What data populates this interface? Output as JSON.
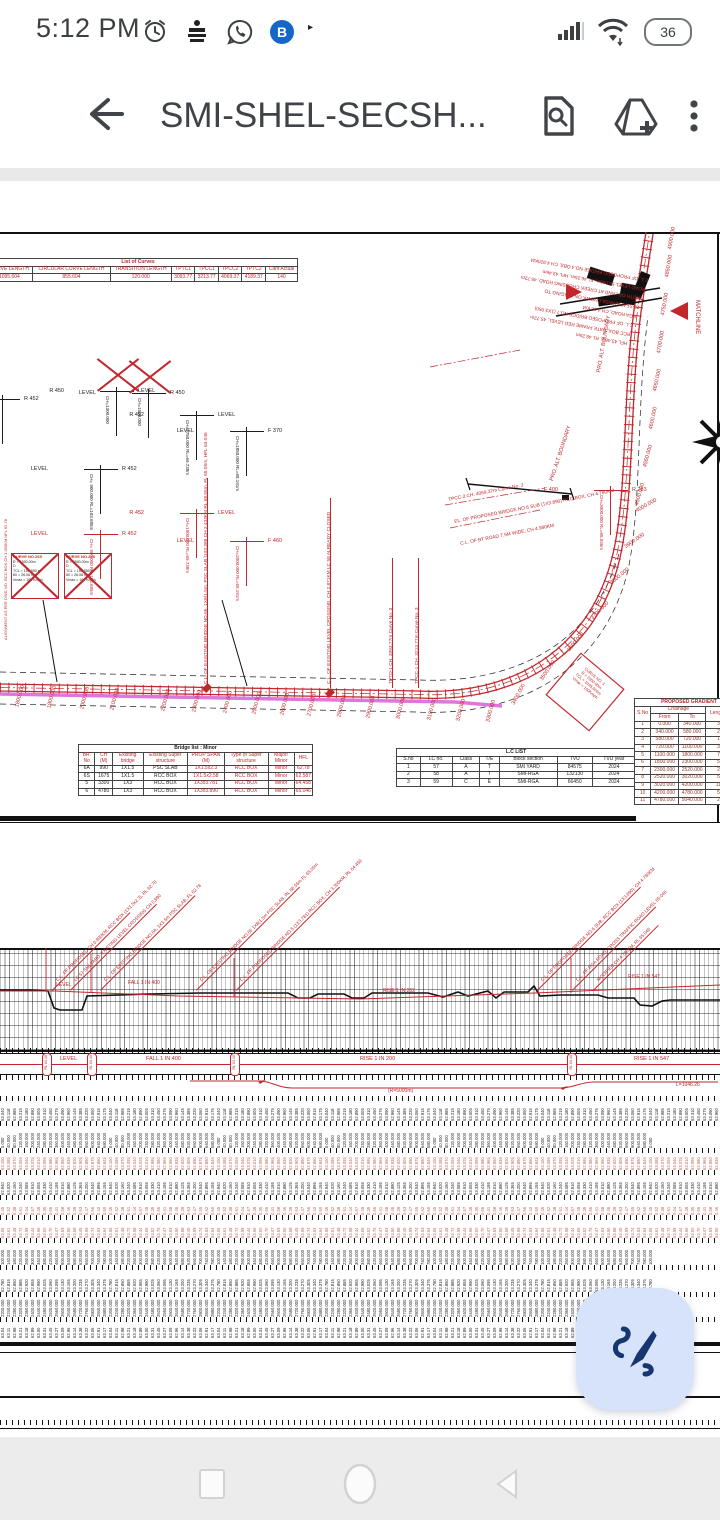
{
  "status_bar": {
    "time": "5:12 PM",
    "battery_percent": "36",
    "notification_icons": [
      "alarm-icon",
      "news-app-icon",
      "whatsapp-icon",
      "bob-app-icon"
    ],
    "more_indicator": "▸"
  },
  "app_bar": {
    "title": "SMI-SHEL-SECSH...",
    "actions": [
      "find-in-page",
      "add-to-drive",
      "more-options"
    ]
  },
  "plan": {
    "curves_table": {
      "title": "List of Curves",
      "headers": [
        "N",
        "CURVE LENGTH",
        "CIRCULAR CURVE LENGTH",
        "TRANSITION LENGTH",
        "TPTC1",
        "TPCC1",
        "TPCC2",
        "TPTC2",
        "Cant Actual"
      ],
      "row": [
        "",
        "1095.604",
        "855.604",
        "120.000",
        "3093.77",
        "3213.77",
        "4069.37",
        "4189.37",
        "140"
      ]
    },
    "crossed_curve_boxes": [
      {
        "title": "CURVE NO.265",
        "lines": [
          "R    = 1500.00m",
          "D",
          "TCL  = 150.550 m",
          "60   = 26.06 mm",
          "Vmax = 160 Kmph"
        ]
      },
      {
        "title": "CURVE NO.248",
        "lines": [
          "R    = 2500.00m",
          "D",
          "TCL  = 150.550 m",
          "60   = 26.06 mm",
          "Vmax = 160 Kmph"
        ]
      }
    ],
    "level_crossings": [
      {
        "x": -14,
        "y": 396,
        "color": "#1d1d1f",
        "left": "LEVEL",
        "right": "R 452",
        "note": "CH= 800.000",
        "crossed": false
      },
      {
        "x": 84,
        "y": 466,
        "color": "#1d1d1f",
        "left": "LEVEL",
        "right": "R 452",
        "note": "CH= 900.000  RL=103.685m",
        "crossed": false
      },
      {
        "x": 100,
        "y": 388,
        "color": "#1d1d1f",
        "left": "R 450",
        "right": "LEVEL",
        "note": "CH=1300.000",
        "crossed": true
      },
      {
        "x": 132,
        "y": 390,
        "color": "#1d1d1f",
        "left": "LEVEL",
        "right": "R 450",
        "note": "CH=1500.000",
        "crossed": true
      },
      {
        "x": 180,
        "y": 412,
        "color": "#1d1d1f",
        "left": "R 452",
        "right": "LEVEL",
        "note": "CH=1750.000  RL=69.738m",
        "crossed": false
      },
      {
        "x": 230,
        "y": 428,
        "color": "#1d1d1f",
        "left": "LEVEL",
        "right": "F 370",
        "note": "CH=1850.000  RL=68.191m",
        "crossed": false
      },
      {
        "x": 84,
        "y": 531,
        "color": "#c2272d",
        "left": "LEVEL",
        "right": "R 452",
        "note": "CH= 900.000  RL=103.685m",
        "crossed": false
      },
      {
        "x": 180,
        "y": 510,
        "color": "#c2272d",
        "left": "R 452",
        "right": "LEVEL",
        "note": "CH=1900.000  RL=69.738m",
        "crossed": false
      },
      {
        "x": 230,
        "y": 538,
        "color": "#c2272d",
        "left": "LEVEL",
        "right": "F 460",
        "note": "CH=2000.000  RL=68.191m",
        "crossed": false
      },
      {
        "x": 594,
        "y": 487,
        "color": "#c2272d",
        "left": "F 400",
        "right": "R 283",
        "note": "CH=3000.000  RL=65.046m",
        "crossed": false
      }
    ],
    "track_leaders": [
      {
        "x": 207,
        "h": 210,
        "text": "C.L. OF EXISTING BRIDGE NO.66, 1X8(1.5m, PSC SLAB,)103.388 CH 2.433KM  RL 68.55m, FL 65.05m, HFL 63.046"
      },
      {
        "x": 330,
        "h": 190,
        "text": "C.L. OF EXISTING LEVEL CROSSING, CH 2.871KM  LC 58 ALREADY CLOSED"
      },
      {
        "x": 392,
        "h": 130,
        "text": "TPTO-1 CH. 3093.77m Curve No. 3"
      },
      {
        "x": 418,
        "h": 130,
        "text": "TPCC-1 CH. 3213.77m Curve No. 3"
      }
    ],
    "curve_leaders": [
      {
        "text": "TPCC-2 CH. 4069.37m Curve No. 3"
      },
      {
        "text": "EL. OF PROPOSED BRIDGE NO.6 SUB (1X3.890) RCC BOX, CH 4.780KM"
      },
      {
        "text": "C.L. OF BT ROAD 7.5M WIDE, CH 4.980KM"
      }
    ],
    "boundary_label": "PRO. ALT. BOUNDARY",
    "matchline_label": "MATCHLINE",
    "left_edge_note": "ALIGNMENT AS PER DWG NO. RCC BOX CH 1.050KM  HFL 62.78",
    "top_right_notes": [
      "C.L. OF PROPOSED BRIDGE NO.4 OBS, CH 4.920KM",
      "ROAD LEVEL 66.046m, FL 46.25m, HFL 43.46m",
      "WIDTH OF LAND AT CREEK CROSSING ROAD, 45.72m",
      "25 SEAT AHINSA CHOWK ON STAGING TO",
      "RGA ROAD, CH 4.98 KM",
      "C.L. OF PROPOSED BRIDGE NO.7 (1X3.050)",
      "RCC BOX, DATE FRAME RED LEVEL, 45.72m",
      "HFL 43.46m, RL 48.25m"
    ],
    "diamond_note_lines": [
      "CURVE NO. 3",
      "R = 2500.00m",
      "TCL = 1095.604m",
      "Vmax = 160Kmph"
    ],
    "chainage_labels": [
      {
        "t": "1800.000",
        "x": 20,
        "y": 702,
        "r": 75
      },
      {
        "t": "1900.000",
        "x": 52,
        "y": 703,
        "r": 75
      },
      {
        "t": "2000.000",
        "x": 85,
        "y": 704,
        "r": 75
      },
      {
        "t": "2100.000",
        "x": 115,
        "y": 705,
        "r": 75
      },
      {
        "t": "2200.000",
        "x": 166,
        "y": 706,
        "r": 75
      },
      {
        "t": "2300.000",
        "x": 197,
        "y": 707,
        "r": 75
      },
      {
        "t": "2400.000",
        "x": 228,
        "y": 708,
        "r": 75
      },
      {
        "t": "2500.000",
        "x": 257,
        "y": 709,
        "r": 75
      },
      {
        "t": "2600.000",
        "x": 285,
        "y": 710,
        "r": 75
      },
      {
        "t": "2700.000",
        "x": 312,
        "y": 711,
        "r": 75
      },
      {
        "t": "2800.000",
        "x": 342,
        "y": 712,
        "r": 75
      },
      {
        "t": "2900.000",
        "x": 371,
        "y": 713,
        "r": 75
      },
      {
        "t": "3000.000",
        "x": 401,
        "y": 714,
        "r": 75
      },
      {
        "t": "3100.000",
        "x": 432,
        "y": 715,
        "r": 75
      },
      {
        "t": "3200.000",
        "x": 461,
        "y": 716,
        "r": 75
      },
      {
        "t": "3300.000",
        "x": 491,
        "y": 717,
        "r": 75
      },
      {
        "t": "3400.000",
        "x": 516,
        "y": 700,
        "r": 62
      },
      {
        "t": "3500.000",
        "x": 544,
        "y": 676,
        "r": 56
      },
      {
        "t": "3600.000",
        "x": 571,
        "y": 647,
        "r": 50
      },
      {
        "t": "3700.000",
        "x": 594,
        "y": 615,
        "r": 45
      },
      {
        "t": "3800.000",
        "x": 613,
        "y": 580,
        "r": 40
      },
      {
        "t": "3900.000",
        "x": 627,
        "y": 544,
        "r": 35
      },
      {
        "t": "4000.000",
        "x": 638,
        "y": 508,
        "r": 30
      },
      {
        "t": "4500.000",
        "x": 640,
        "y": 500,
        "r": 75
      },
      {
        "t": "4550.000",
        "x": 648,
        "y": 462,
        "r": 75
      },
      {
        "t": "4600.000",
        "x": 654,
        "y": 424,
        "r": 78
      },
      {
        "t": "4650.000",
        "x": 658,
        "y": 386,
        "r": 78
      },
      {
        "t": "4700.000",
        "x": 662,
        "y": 348,
        "r": 80
      },
      {
        "t": "4750.000",
        "x": 666,
        "y": 310,
        "r": 80
      },
      {
        "t": "4850.000",
        "x": 670,
        "y": 272,
        "r": 80
      },
      {
        "t": "4900.000",
        "x": 673,
        "y": 244,
        "r": 80
      }
    ],
    "bridge_table": {
      "title": "Bridge list : Minor",
      "headers": [
        "BR. No",
        "CH (M)",
        "Existing bridge",
        "Existing Super structure",
        "PROP SPAN (M)",
        "Type of Super structure",
        "Major/ Minor",
        "HFL"
      ],
      "rows": [
        [
          "6A",
          "990",
          "1X1.5",
          "PSC SLAB",
          "1X1.5x2.3",
          "RCC BOX",
          "Minor",
          "62.78"
        ],
        [
          "6S",
          "1675",
          "1X1.5",
          "RCC BOX",
          "1X1.5x2.58",
          "RCC BOX",
          "Minor",
          "62.587"
        ],
        [
          "5",
          "3300",
          "1X3",
          "RCC BOX",
          "1X3x3.781",
          "RCC BOX",
          "Minor",
          "64.458"
        ],
        [
          "6",
          "4780",
          "1X3",
          "RCC BOX",
          "1X3x3.890",
          "RCC BOX",
          "Minor",
          "65.046"
        ]
      ]
    },
    "lc_table": {
      "title": "L.C LIST",
      "headers": [
        "S.no",
        "LC no.",
        "Class",
        "T/E",
        "Block section",
        "TVU",
        "TVU year"
      ],
      "rows": [
        [
          "1",
          "57",
          "A",
          "T",
          "SMI YARD",
          "84575",
          "2024"
        ],
        [
          "2",
          "58",
          "A",
          "T",
          "SMI-RGA",
          "132130",
          "2024"
        ],
        [
          "3",
          "59",
          "C",
          "E",
          "SMI-RGA",
          "66450",
          "2024"
        ]
      ]
    },
    "gradient_table": {
      "title": "PROPOSED GRADIENT",
      "col_sno": "S.No",
      "col_chainage": "Chainage",
      "col_from": "From",
      "col_to": "To",
      "col_length": "Length Metre",
      "rows": [
        [
          "1",
          "0.000",
          "340.000",
          "340.00"
        ],
        [
          "2",
          "340.000",
          "580.000",
          "240.00"
        ],
        [
          "3",
          "580.000",
          "720.000",
          "140.00"
        ],
        [
          "4",
          "720.000",
          "1100.000",
          "380.00"
        ],
        [
          "5",
          "1100.000",
          "1800.000",
          "700.00"
        ],
        [
          "6",
          "1800.000",
          "2300.000",
          "500.00"
        ],
        [
          "7",
          "2300.000",
          "2520.000",
          "220.00"
        ],
        [
          "8",
          "2520.000",
          "3020.000",
          "500.00"
        ],
        [
          "9",
          "3020.000",
          "4200.000",
          "1180.00"
        ],
        [
          "10",
          "4200.000",
          "4780.000",
          "580.00"
        ],
        [
          "11",
          "4780.000",
          "5040.000",
          "260.00"
        ]
      ]
    }
  },
  "profile": {
    "diagonal_notes": [
      {
        "x": 52,
        "l": 110,
        "t": "C.L. OF PROPOSED CH 0.990KM, RCC BOX (1X1.5x2.3), RL 62.78"
      },
      {
        "x": 70,
        "l": 122,
        "t": "LC 57 SMI YARD, EXISTING LEVEL CROSSING CH 0.990"
      },
      {
        "x": 100,
        "l": 134,
        "t": "C.L. OF EXISTING BRIDGE NO.6A, 1X1.5m PSC SLAB, FL 62.78"
      },
      {
        "x": 196,
        "l": 146,
        "t": "C.L. OF EXISTING BRIDGE NO.66 1X8(1.5m PSC SLAB, RL 68.55m FL 65.05m"
      },
      {
        "x": 236,
        "l": 146,
        "t": "C.L. OF PROPOSED BRIDGE NO.5 (1X3.781) RCC BOX, CH 3.300KM, RL 64.458"
      },
      {
        "x": 537,
        "l": 146,
        "t": "C.L. OF PROPOSED BRIDGE NO.6 SUB, RCC BOX (1X3.890), CH 4.780KM"
      },
      {
        "x": 572,
        "l": 118,
        "t": "C.L. OF RGA ROAD, CROSS TRAFFIC ROAD LEVEL 65.046"
      },
      {
        "x": 593,
        "l": 92,
        "t": "MODIFIED CH 4.780KM, RL 65.046"
      }
    ],
    "grid_labels": [
      {
        "t": "LEVEL",
        "x": 56,
        "y": 982
      },
      {
        "t": "FALL 1 IN 400",
        "x": 128,
        "y": 980
      },
      {
        "t": "RISE 1 IN 262",
        "x": 383,
        "y": 988
      },
      {
        "t": "RISE 1 IN 547",
        "x": 628,
        "y": 974
      }
    ],
    "band_labels": [
      {
        "t": "LEVEL",
        "x": 60
      },
      {
        "t": "FALL 1 IN 400",
        "x": 146
      },
      {
        "t": "RISE 1 IN 200",
        "x": 360
      },
      {
        "t": "RISE 1 IN 547",
        "x": 634
      }
    ],
    "pill_xs": [
      46,
      91,
      234,
      571
    ],
    "pill_text": "RL 63.10",
    "vc_label": "L=1046.26",
    "vc_mid_label": "(R=5000m)",
    "data_rows": [
      {
        "color": "#1d1d1f",
        "h": 20,
        "end": 718,
        "values": [
          "63.040",
          "63.118",
          "62.985",
          "63.215",
          "63.180",
          "62.890",
          "63.005",
          "63.310",
          "63.450",
          "63.275",
          "63.090",
          "62.960",
          "63.145",
          "63.385",
          "63.220",
          "63.060",
          "62.915",
          "63.175"
        ]
      },
      {
        "color": "#1d1d1f",
        "h": 22,
        "end": 655,
        "values": [
          "0.000",
          "40.000",
          "80.000",
          "120.000",
          "160.000",
          "200.000",
          "240.000",
          "280.000",
          "320.000",
          "360.000",
          "400.000",
          "440.000",
          "480.000",
          "520.000",
          "560.000",
          "600.000",
          "640.000",
          "680.000"
        ]
      },
      {
        "color": "#c75f55",
        "h": 17,
        "end": 718,
        "values": [
          "63.100",
          "63.085",
          "63.070",
          "63.055",
          "63.040",
          "63.025",
          "63.010",
          "62.995",
          "62.980",
          "62.965",
          "62.950",
          "62.935",
          "62.920",
          "62.905",
          "62.890",
          "62.875",
          "62.860",
          "62.845"
        ]
      },
      {
        "color": "#1d1d1f",
        "h": 20,
        "end": 718,
        "values": [
          "62.940",
          "63.020",
          "63.160",
          "63.240",
          "63.085",
          "62.910",
          "63.055",
          "63.330",
          "63.410",
          "63.195",
          "63.010",
          "62.880",
          "63.125",
          "63.365",
          "63.200",
          "63.040",
          "62.895",
          "63.155"
        ]
      },
      {
        "color": "#c75f55",
        "h": 15,
        "end": 718,
        "values": [
          "0.45",
          "0.52",
          "0.38",
          "0.61",
          "0.44",
          "0.57",
          "0.49",
          "0.35",
          "0.66",
          "0.41",
          "0.58",
          "0.46",
          "0.39",
          "0.63",
          "0.47",
          "0.55",
          "0.42",
          "0.60"
        ]
      },
      {
        "color": "#c75f55",
        "h": 18,
        "end": 718,
        "values": [
          "63.55",
          "63.61",
          "63.48",
          "63.72",
          "63.58",
          "63.44",
          "63.66",
          "63.52",
          "63.70",
          "63.47",
          "63.63",
          "63.50",
          "63.68",
          "63.45",
          "63.59",
          "63.74",
          "63.53",
          "63.64"
        ]
      },
      {
        "color": "#1d1d1f",
        "h": 22,
        "end": 655,
        "values": [
          "100.000",
          "140.000",
          "180.000",
          "220.000",
          "260.000",
          "300.000",
          "340.000",
          "380.000",
          "420.000",
          "460.000",
          "500.000",
          "540.000",
          "580.000",
          "620.000",
          "660.000",
          "700.000",
          "740.000",
          "780.000"
        ]
      },
      {
        "color": "#1d1d1f",
        "h": 22,
        "end": 655,
        "values": [
          "62.780",
          "62.815",
          "62.850",
          "62.885",
          "62.920",
          "62.955",
          "62.990",
          "63.025",
          "63.060",
          "63.095",
          "63.130",
          "63.165",
          "63.200",
          "63.235",
          "63.270",
          "63.305",
          "63.340",
          "63.375"
        ]
      },
      {
        "color": "#1d1d1f",
        "h": 20,
        "end": 655,
        "values": [
          "2200.000",
          "2240.000",
          "2280.000",
          "2320.000",
          "2360.000",
          "2400.000",
          "2440.000",
          "2480.000",
          "2520.000",
          "2560.000",
          "2600.000",
          "2640.000",
          "2680.000",
          "2720.000",
          "2760.000",
          "2800.000",
          "2840.000",
          "2880.000"
        ]
      },
      {
        "color": "#1d1d1f",
        "h": 16,
        "end": 655,
        "values": [
          "63.04",
          "63.11",
          "62.98",
          "63.21",
          "63.18",
          "62.89",
          "63.00",
          "63.31",
          "63.45",
          "63.27",
          "63.09",
          "62.96",
          "63.14",
          "63.38",
          "63.22",
          "63.06",
          "62.91",
          "63.17"
        ]
      }
    ]
  },
  "fab": {
    "icon": "annotate-pen-icon"
  },
  "nav": {
    "buttons": [
      "recents",
      "home",
      "back"
    ]
  },
  "colors": {
    "red": "#c2272d",
    "magenta": "#d75fd7",
    "fab_bg": "#d6e3fa",
    "fab_icon": "#17356e"
  }
}
